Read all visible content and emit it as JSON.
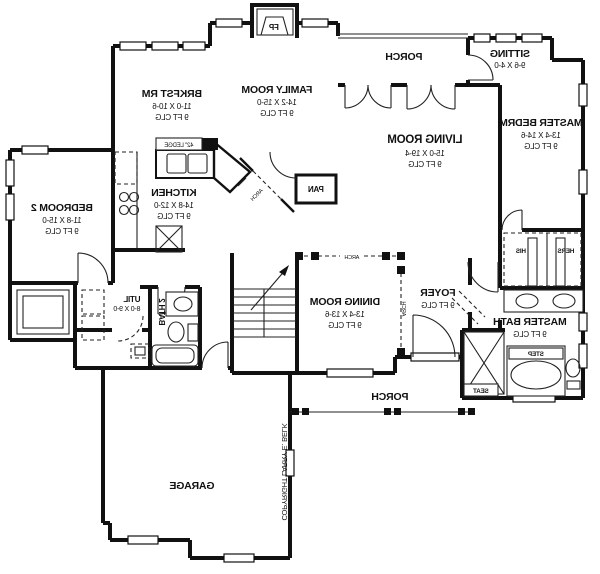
{
  "rooms": {
    "brkfst": {
      "name": "BRKFST RM",
      "dims": "11-0 X 10-6",
      "clg": "9 FT CLG"
    },
    "family": {
      "name": "FAMILY ROOM",
      "dims": "14-2 X 15-0",
      "clg": "9 FT CLG"
    },
    "porch_top": {
      "name": "PORCH"
    },
    "sitting": {
      "name": "SITTING",
      "dims": "9-6 X 4-0"
    },
    "master_bedrm": {
      "name": "MASTER BEDRM",
      "dims": "13-4 X 14-6",
      "clg": "9 FT CLG"
    },
    "living": {
      "name": "LIVING ROOM",
      "dims": "15-0 X 19-4",
      "clg": "9 FT CLG"
    },
    "kitchen": {
      "name": "KITCHEN",
      "dims": "14-8 X 12-0",
      "clg": "9 FT CLG"
    },
    "bedroom2": {
      "name": "BEDROOM 2",
      "dims": "11-8 X 15-0",
      "clg": "9 FT CLG"
    },
    "util": {
      "name": "UTIL",
      "dims": "8-0 X 9-0"
    },
    "bath2": {
      "name": "BATH 2"
    },
    "dining": {
      "name": "DINING ROOM",
      "dims": "13-4 X 13-6",
      "clg": "9 FT CLG"
    },
    "foyer": {
      "name": "FOYER",
      "clg": "9 FT CLG"
    },
    "master_bath": {
      "name": "MASTER BATH",
      "clg": "9 FT CLG"
    },
    "his": {
      "name": "HIS"
    },
    "hers": {
      "name": "HERS"
    },
    "porch_bottom": {
      "name": "PORCH"
    },
    "garage": {
      "name": "GARAGE"
    },
    "pantry": {
      "name": "PAN"
    }
  },
  "labels": {
    "fireplace": "FP",
    "ledge": "42\" LEDGE",
    "arch": "ARCH",
    "step": "STEP",
    "seat": "SEAT",
    "copyright": "COPYRIGHT LARRY E. BELK"
  },
  "colors": {
    "wall": "#111111",
    "background": "#ffffff"
  }
}
